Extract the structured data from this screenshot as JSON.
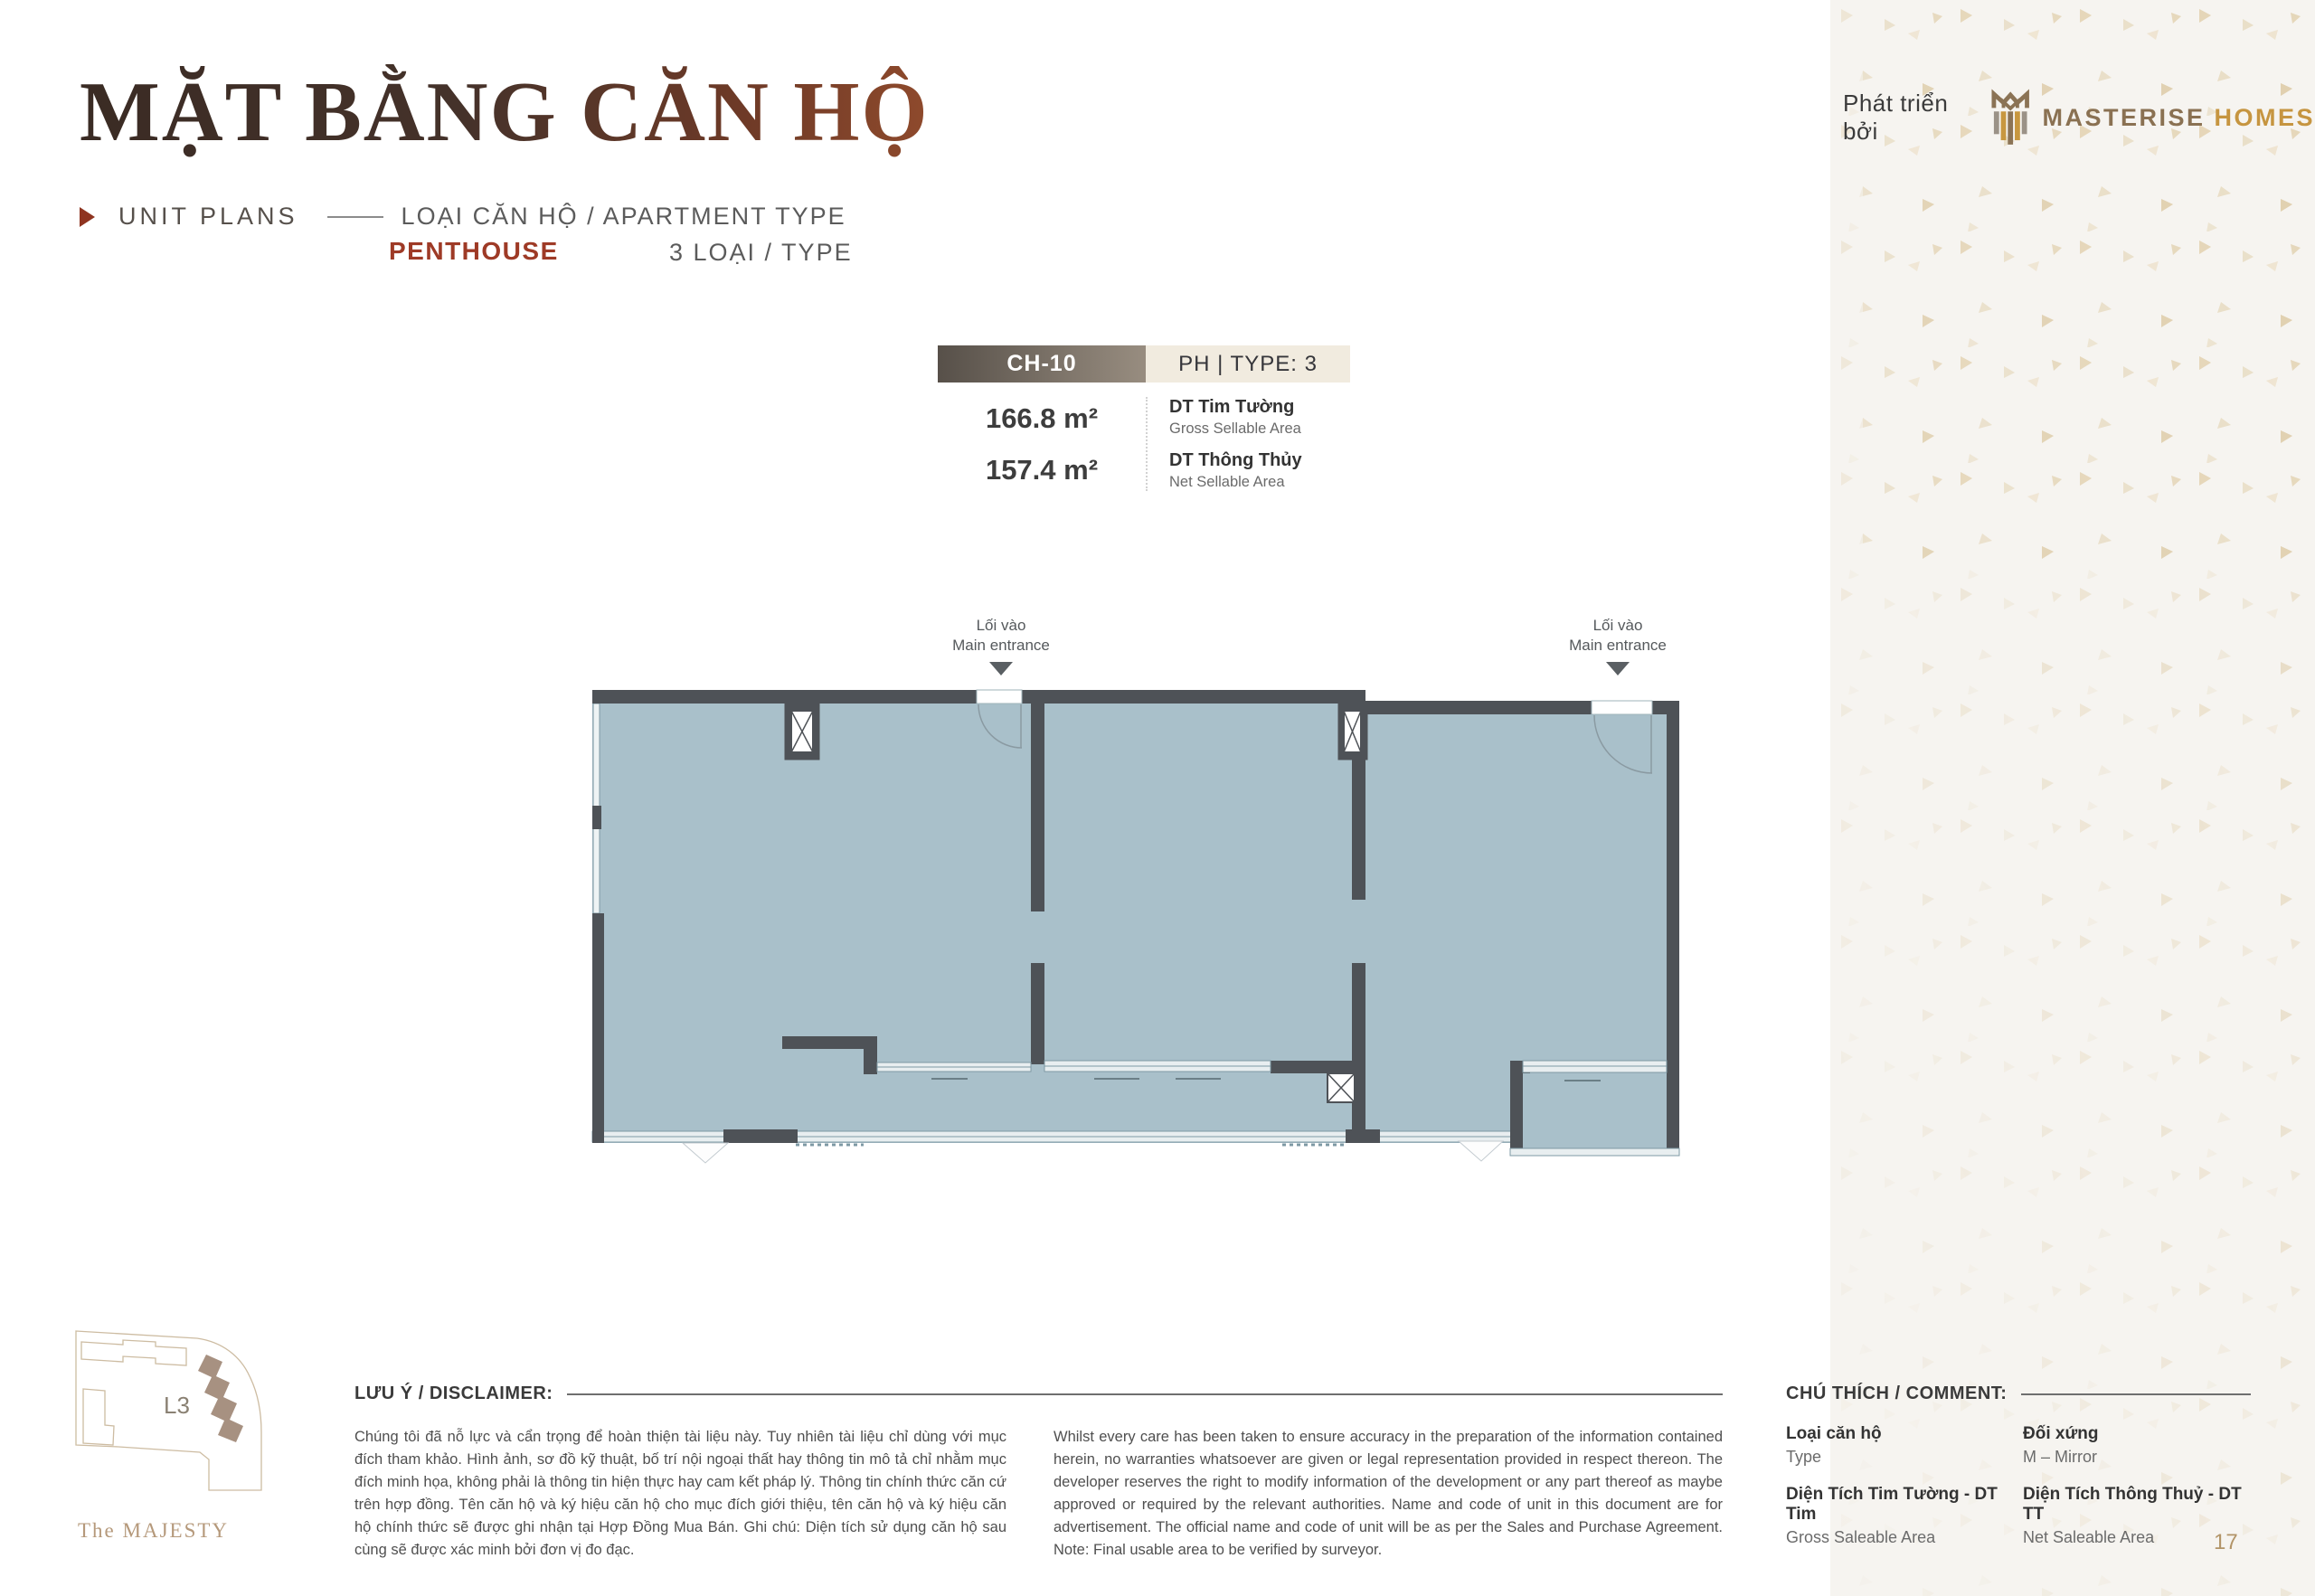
{
  "header": {
    "title": "MẶT BẰNG CĂN HỘ",
    "unit_plans": "UNIT PLANS",
    "apartment_type_label": "LOẠI CĂN HỘ / APARTMENT TYPE",
    "type_name": "PENTHOUSE",
    "type_count": "3 LOẠI / TYPE"
  },
  "developer": {
    "prefix": "Phát triển bởi",
    "brand_primary": "MASTERISE",
    "brand_secondary": "HOMES"
  },
  "unit_card": {
    "unit_code": "CH-10",
    "type_badge": "PH | TYPE: 3",
    "gross_area": "166.8 m²",
    "net_area": "157.4 m²",
    "gross_label_vi": "DT Tim Tường",
    "gross_label_en": "Gross Sellable Area",
    "net_label_vi": "DT Thông Thủy",
    "net_label_en": "Net Sellable Area"
  },
  "floorplan": {
    "entrance_label_vi": "Lối vào",
    "entrance_label_en": "Main entrance"
  },
  "sitemap": {
    "block_label": "L3",
    "project_name": "The MAJESTY"
  },
  "disclaimer": {
    "heading": "LƯU Ý / DISCLAIMER:",
    "text_vi": "Chúng tôi đã nỗ lực và cẩn trọng để hoàn thiện tài liệu này. Tuy nhiên tài liệu chỉ dùng với mục đích tham khảo. Hình ảnh, sơ đồ kỹ thuật, bố trí nội ngoại thất hay thông tin mô tả chỉ nhằm mục đích minh họa, không phải là thông tin hiện thực hay cam kết pháp lý. Thông tin chính thức căn cứ trên hợp đồng. Tên căn hộ và ký hiệu căn hộ cho mục đích giới thiệu, tên căn hộ và ký hiệu căn hộ chính thức sẽ được ghi nhận tại Hợp Đồng Mua Bán. Ghi chú: Diện tích sử dụng căn hộ sau cùng sẽ được xác minh bởi đơn vị đo đạc.",
    "text_en": "Whilst every care has been taken to ensure accuracy in the preparation of the information contained herein, no warranties whatsoever are given or legal representation provided in respect thereon. The developer reserves the right to modify information of the development or any part thereof as maybe approved or required by the relevant authorities. Name and code of unit in this document are for advertisement. The official name and code of unit will be as per the Sales and Purchase Agreement. Note: Final usable area to be verified by surveyor."
  },
  "legend": {
    "heading": "CHÚ THÍCH / COMMENT:",
    "items": [
      {
        "title": "Loại căn hộ",
        "subtitle": "Type"
      },
      {
        "title": "Đối xứng",
        "subtitle": "M – Mirror"
      },
      {
        "title": "Diện Tích Tim Tường - DT Tim",
        "subtitle": "Gross Saleable Area"
      },
      {
        "title": "Diện Tích Thông Thuỷ - DT TT",
        "subtitle": "Net Saleable Area"
      }
    ]
  },
  "page": {
    "number": "17"
  },
  "colors": {
    "accent_red": "#9e3a26",
    "wall_gray": "#4e5257",
    "floor_fill": "#a9c0ca",
    "brand_brown": "#8a7152",
    "brand_gold": "#c69540",
    "badge_cream": "#f1ebdf",
    "page_tan": "#b29468"
  }
}
